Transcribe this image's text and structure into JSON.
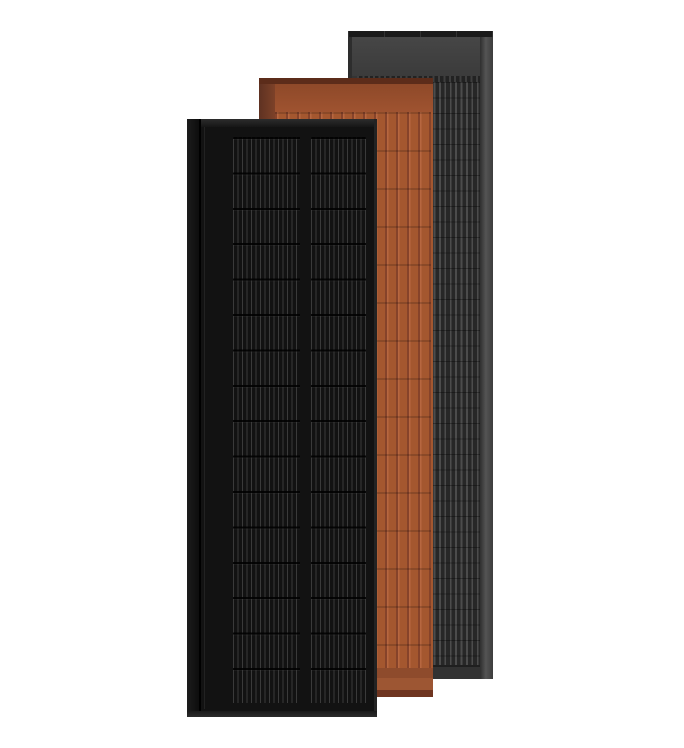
{
  "scene": {
    "description": "Product render of three overlapping tall slim solar panels in different colorways on a white background",
    "panels": [
      {
        "colorway": "slate-gray",
        "position": "back-right",
        "z_order": 1
      },
      {
        "colorway": "terracotta",
        "position": "middle",
        "z_order": 2
      },
      {
        "colorway": "all-black",
        "position": "front-left",
        "z_order": 3
      }
    ]
  },
  "colors": {
    "background": "#ffffff",
    "slate_frame": "#343434",
    "slate_top_cap": "#1a1a1a",
    "slate_header_hi": "#464646",
    "slate_header_lo": "#3b3b3b",
    "slate_cell_bg": "#272727",
    "slate_cell_line": "#4c4c4c",
    "slate_bottom": "#323232",
    "slate_right_hi": "#545454",
    "terracotta_face": "#a4572f",
    "terracotta_groove": "#86432a",
    "terracotta_highlight": "#b76740",
    "terracotta_top_cap": "#5c2c1a",
    "terracotta_header_hi": "#8e4929",
    "terracotta_header_lo": "#9f5330",
    "terracotta_edge_dark": "#5e3222",
    "terracotta_edge_lite": "#7d4128",
    "terracotta_foot_a": "#8e4b2c",
    "terracotta_foot_b": "#9d5633",
    "terracotta_foot_c": "#6f3520",
    "black_face": "#121212",
    "black_top_hi": "#2c2c2c",
    "black_top_lo": "#161616",
    "black_cell_line": "#3a3a3a",
    "black_flange_hi": "#1c1c1c",
    "black_flange_lo": "#0d0d0d",
    "black_bottom_edge": "#2b2b2b",
    "black_right_edge": "#232323"
  }
}
